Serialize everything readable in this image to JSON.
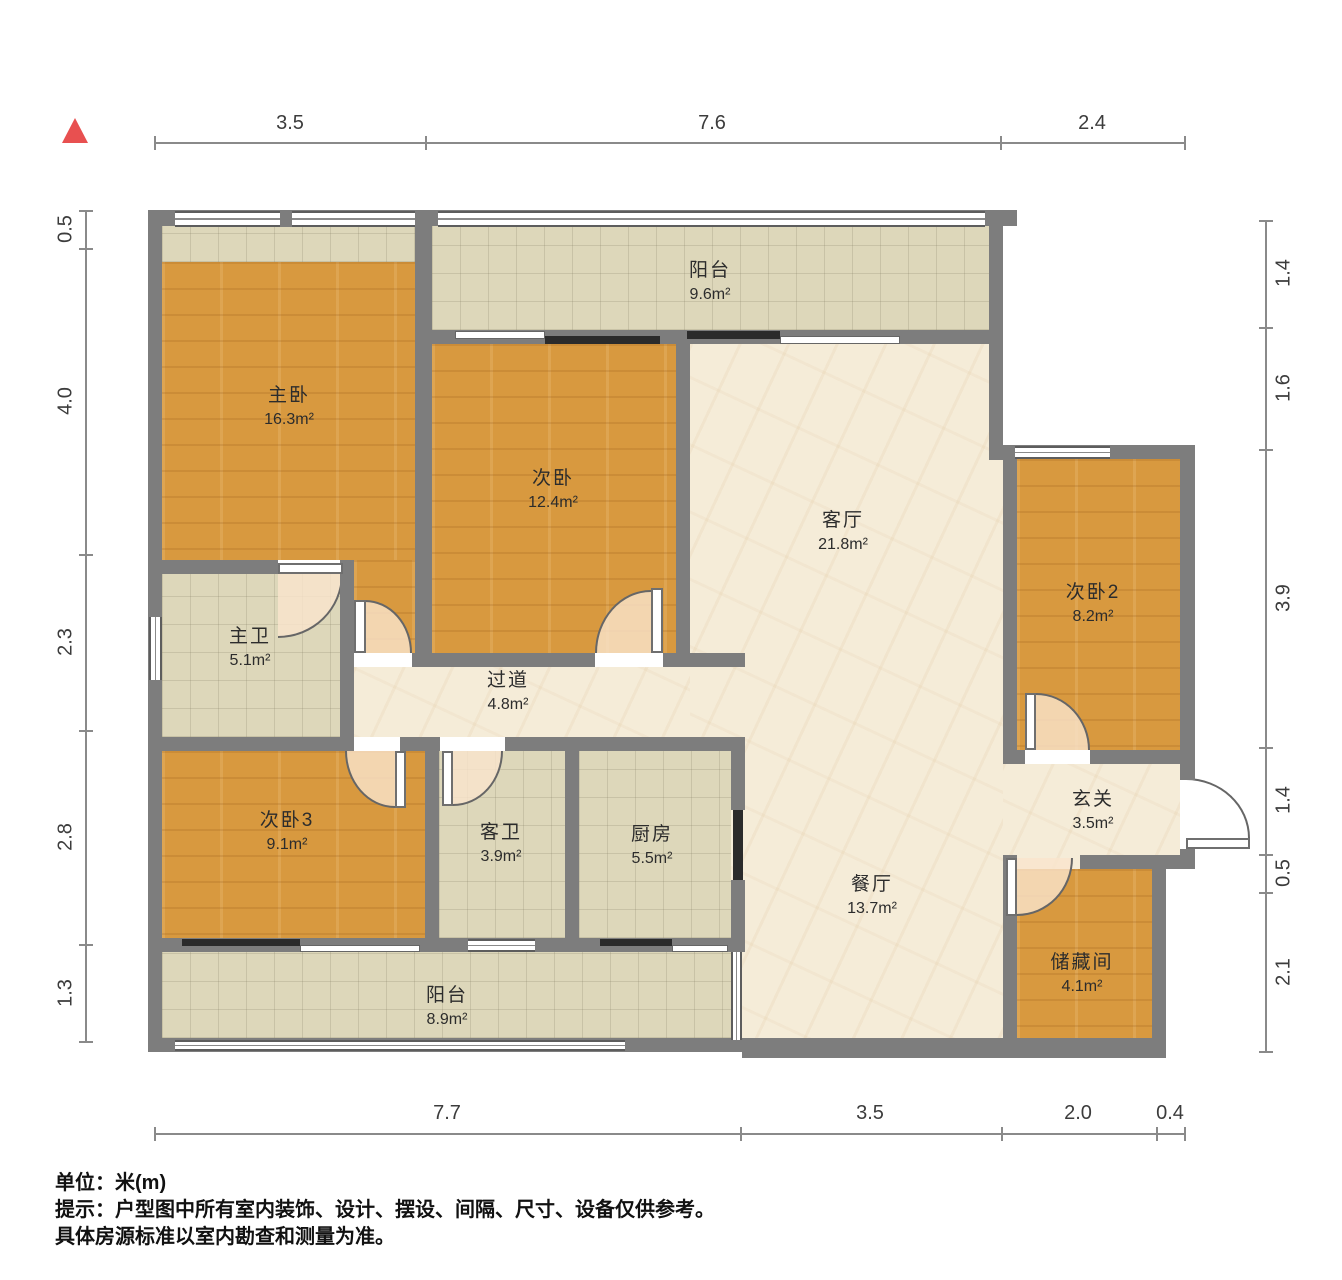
{
  "title": "户型图",
  "compass": {
    "icon": "north-triangle"
  },
  "rooms": [
    {
      "id": "balcony-top",
      "name": "阳台",
      "area": "9.6m²"
    },
    {
      "id": "master-bedroom",
      "name": "主卧",
      "area": "16.3m²"
    },
    {
      "id": "bedroom-2",
      "name": "次卧",
      "area": "12.4m²"
    },
    {
      "id": "living-room",
      "name": "客厅",
      "area": "21.8m²"
    },
    {
      "id": "bedroom-3",
      "name": "次卧2",
      "area": "8.2m²"
    },
    {
      "id": "master-bath",
      "name": "主卫",
      "area": "5.1m²"
    },
    {
      "id": "hallway",
      "name": "过道",
      "area": "4.8m²"
    },
    {
      "id": "bedroom-4",
      "name": "次卧3",
      "area": "9.1m²"
    },
    {
      "id": "guest-bath",
      "name": "客卫",
      "area": "3.9m²"
    },
    {
      "id": "kitchen",
      "name": "厨房",
      "area": "5.5m²"
    },
    {
      "id": "dining-room",
      "name": "餐厅",
      "area": "13.7m²"
    },
    {
      "id": "entry",
      "name": "玄关",
      "area": "3.5m²"
    },
    {
      "id": "storage",
      "name": "储藏间",
      "area": "4.1m²"
    },
    {
      "id": "balcony-bottom",
      "name": "阳台",
      "area": "8.9m²"
    }
  ],
  "dims": {
    "top": [
      "3.5",
      "7.6",
      "2.4"
    ],
    "bottom": [
      "7.7",
      "3.5",
      "2.0",
      "0.4"
    ],
    "left": [
      "0.5",
      "4.0",
      "2.3",
      "2.8",
      "1.3"
    ],
    "right": [
      "1.4",
      "1.6",
      "3.9",
      "1.4",
      "0.5",
      "2.1"
    ]
  },
  "footer": {
    "unit_label": "单位：",
    "unit_value": "米(m)",
    "tip_label": "提示：",
    "tip_line1": "户型图中所有室内装饰、设计、摆设、间隔、尺寸、设备仅供参考。",
    "tip_line2": "具体房源标准以室内勘查和测量为准。"
  },
  "colors": {
    "wall": "#7d7d7d",
    "wood_floor": "#d8993f",
    "tile_floor": "#ddd7ba",
    "marble_floor": "#f5ecd8",
    "compass_red": "#e85050"
  }
}
